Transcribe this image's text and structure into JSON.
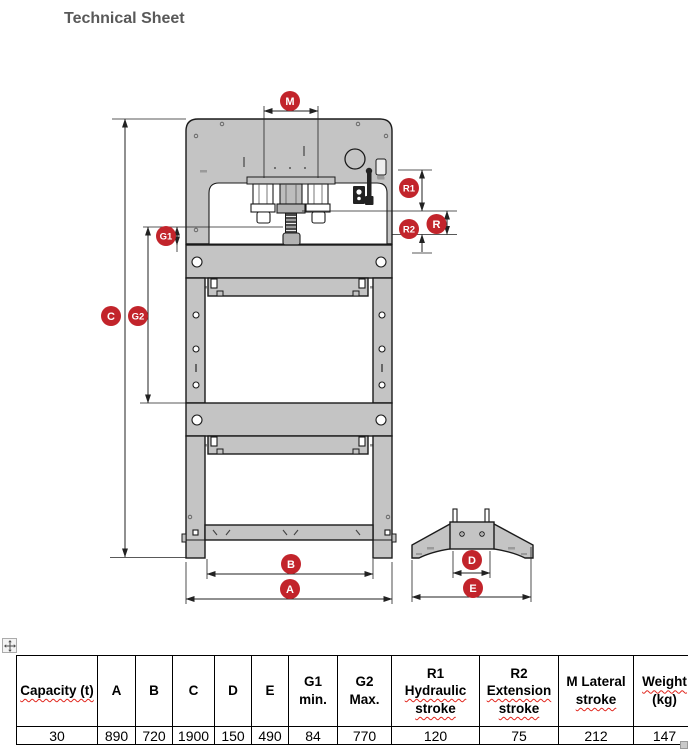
{
  "title": "Technical Sheet",
  "accent_color": "#c2242b",
  "diagram": {
    "labels": {
      "m": "M",
      "r1": "R1",
      "r2": "R2",
      "r": "R",
      "g1": "G1",
      "g2": "G2",
      "c": "C",
      "b": "B",
      "a": "A",
      "d": "D",
      "e": "E"
    }
  },
  "table": {
    "headers": [
      {
        "name": "capacity",
        "lines": [
          {
            "text": "Capacity (t)",
            "misspelled": true
          }
        ]
      },
      {
        "name": "a",
        "lines": [
          {
            "text": "A"
          }
        ]
      },
      {
        "name": "b",
        "lines": [
          {
            "text": "B"
          }
        ]
      },
      {
        "name": "c",
        "lines": [
          {
            "text": "C"
          }
        ]
      },
      {
        "name": "d",
        "lines": [
          {
            "text": "D"
          }
        ]
      },
      {
        "name": "e",
        "lines": [
          {
            "text": "E"
          }
        ]
      },
      {
        "name": "g1-min",
        "lines": [
          {
            "text": "G1"
          },
          {
            "text": "min."
          }
        ]
      },
      {
        "name": "g2-max",
        "lines": [
          {
            "text": "G2"
          },
          {
            "text": "Max."
          }
        ]
      },
      {
        "name": "r1-hydraulic-stroke",
        "lines": [
          {
            "text": "R1"
          },
          {
            "text": "Hydraulic",
            "misspelled": true
          },
          {
            "text": "stroke",
            "misspelled": true
          }
        ]
      },
      {
        "name": "r2-extension-stroke",
        "lines": [
          {
            "text": "R2"
          },
          {
            "text": "Extension",
            "misspelled": true
          },
          {
            "text": "stroke",
            "misspelled": true
          }
        ]
      },
      {
        "name": "m-lateral-stroke",
        "lines": [
          {
            "text": "M Lateral"
          },
          {
            "text": "stroke",
            "misspelled": true
          }
        ]
      },
      {
        "name": "weight",
        "lines": [
          {
            "text": "Weight",
            "misspelled": true
          },
          {
            "text": "(kg)"
          }
        ]
      }
    ],
    "values": [
      "30",
      "890",
      "720",
      "1900",
      "150",
      "490",
      "84",
      "770",
      "120",
      "75",
      "212",
      "147"
    ]
  }
}
